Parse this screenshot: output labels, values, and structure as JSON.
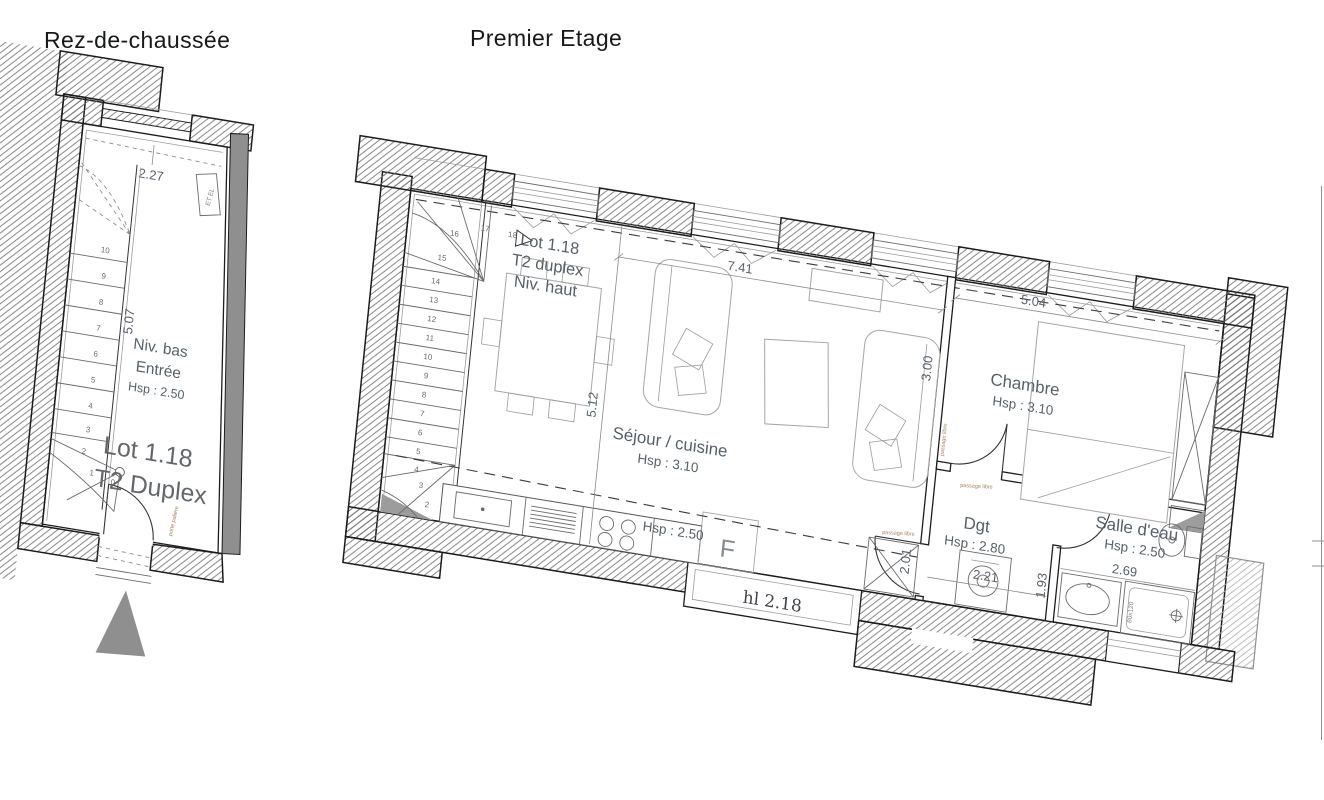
{
  "titles": {
    "ground_floor": "Rez-de-chaussée",
    "first_floor": "Premier Etage"
  },
  "ground_floor": {
    "lot": {
      "line1": "Lot 1.18",
      "line2": "T2 Duplex"
    },
    "room": {
      "level": "Niv. bas",
      "name": "Entrée",
      "height": "Hsp : 2.50"
    },
    "elec_label": "ET EL",
    "door_note": "porte palière",
    "dims": {
      "opening_width": "2.27",
      "stair_length": "5.07"
    },
    "steps": [
      "0",
      "1",
      "2",
      "3",
      "4",
      "5",
      "6",
      "7",
      "8",
      "9",
      "10"
    ]
  },
  "first_floor": {
    "lot": {
      "line1": "Lot 1.18",
      "line2": "T2 duplex",
      "line3": "Niv. haut"
    },
    "rooms": {
      "living": {
        "name": "Séjour / cuisine",
        "height": "Hsp : 3.10"
      },
      "bedroom": {
        "name": "Chambre",
        "height": "Hsp : 3.10"
      },
      "hall": {
        "name": "Dgt",
        "height": "Hsp : 2.80"
      },
      "bath": {
        "name": "Salle d'eau",
        "height": "Hsp : 2.50"
      }
    },
    "low_ceiling": "Hsp : 2.50",
    "window_sill": "hl 2.18",
    "fridge_label": "F",
    "shower_size": "80x120",
    "door_note": "passage libre",
    "dims": {
      "living_length": "7.41",
      "living_width": "5.12",
      "bedroom_length": "5.04",
      "bedroom_width": "3.00",
      "hall_length": "2.21",
      "hall_height": "2.01",
      "bath_length": "2.69",
      "bath_width": "1.93"
    },
    "steps": [
      "2",
      "3",
      "4",
      "5",
      "6",
      "7",
      "8",
      "9",
      "10",
      "11",
      "12",
      "13",
      "14",
      "15",
      "16",
      "17",
      "18"
    ]
  },
  "colors": {
    "ink": "#1c1c1c",
    "label_gray": "#566069",
    "wall_fill": "#8f8f8f",
    "note_brown": "#a3835f",
    "lot_text": "#63676b"
  }
}
